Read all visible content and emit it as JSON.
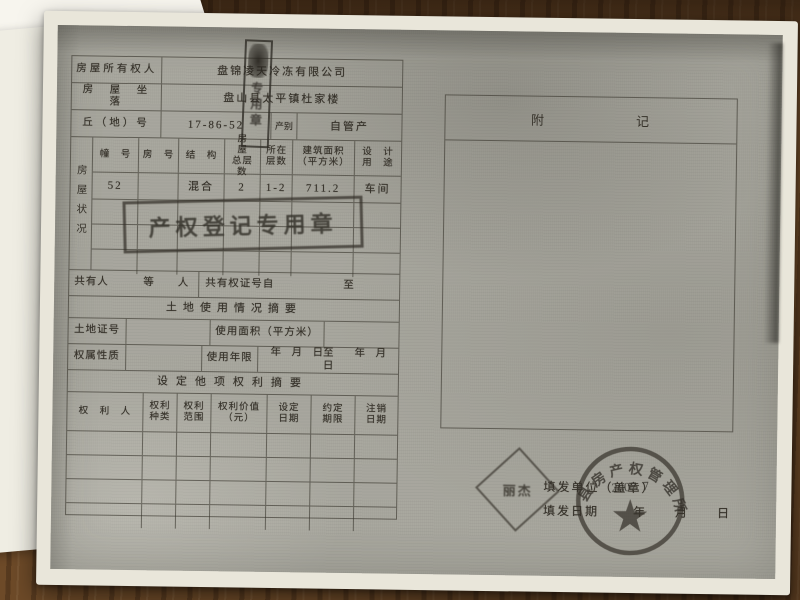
{
  "form": {
    "owner_label": "房屋所有权人",
    "owner_value": "盘锦凌天冷冻有限公司",
    "location_label": "房　屋　坐　落",
    "location_value": "盘山县太平镇杜家楼",
    "plot_label": "丘（地）号",
    "plot_value": "17-86-52",
    "plot_category_label": "产别",
    "plot_category_value": "自管产",
    "status_side_label": "房屋状况",
    "status_columns": [
      "幢　号",
      "房　号",
      "结　构",
      "房　屋\n总层数",
      "所在\n层数",
      "建筑面积\n（平方米）",
      "设　计\n用　途"
    ],
    "status_row": [
      "52",
      "",
      "混合",
      "2",
      "1-2",
      "711.2",
      "车间"
    ],
    "co_owner_left": "共有人　　　等　　人",
    "co_owner_right": "共有权证号自　　　　　　至",
    "land_header": "土地使用情况摘要",
    "land_cert_label": "土地证号",
    "land_area_label": "使用面积（平方米）",
    "tenure_label": "权属性质",
    "tenure_years_label": "使用年限",
    "tenure_dates": "年　月　日至　　年　月　日",
    "rights_header": "设定他项权利摘要",
    "rights_columns": [
      "权　利　人",
      "权利\n种类",
      "权利\n范围",
      "权利价值\n（元）",
      "设定\n日期",
      "约定\n期限",
      "注销\n日期"
    ]
  },
  "appendix": {
    "title_left": "附",
    "title_right": "记"
  },
  "issue": {
    "unit_label": "填发单位（盖章）",
    "date_label": "填发日期",
    "date_units": "年　　月　　日"
  },
  "stamps": {
    "registration_text": "产权登记专用章",
    "vertical_text": "专用章",
    "name_seal_text": "丽杰",
    "circular_rim_text": "县房产权管理所",
    "circular_date": "2007. 7"
  },
  "colors": {
    "wood": "#6d4a28",
    "paper": "#e9e6da",
    "toner_gray": "#a6a59c",
    "ink": "#36322a"
  }
}
